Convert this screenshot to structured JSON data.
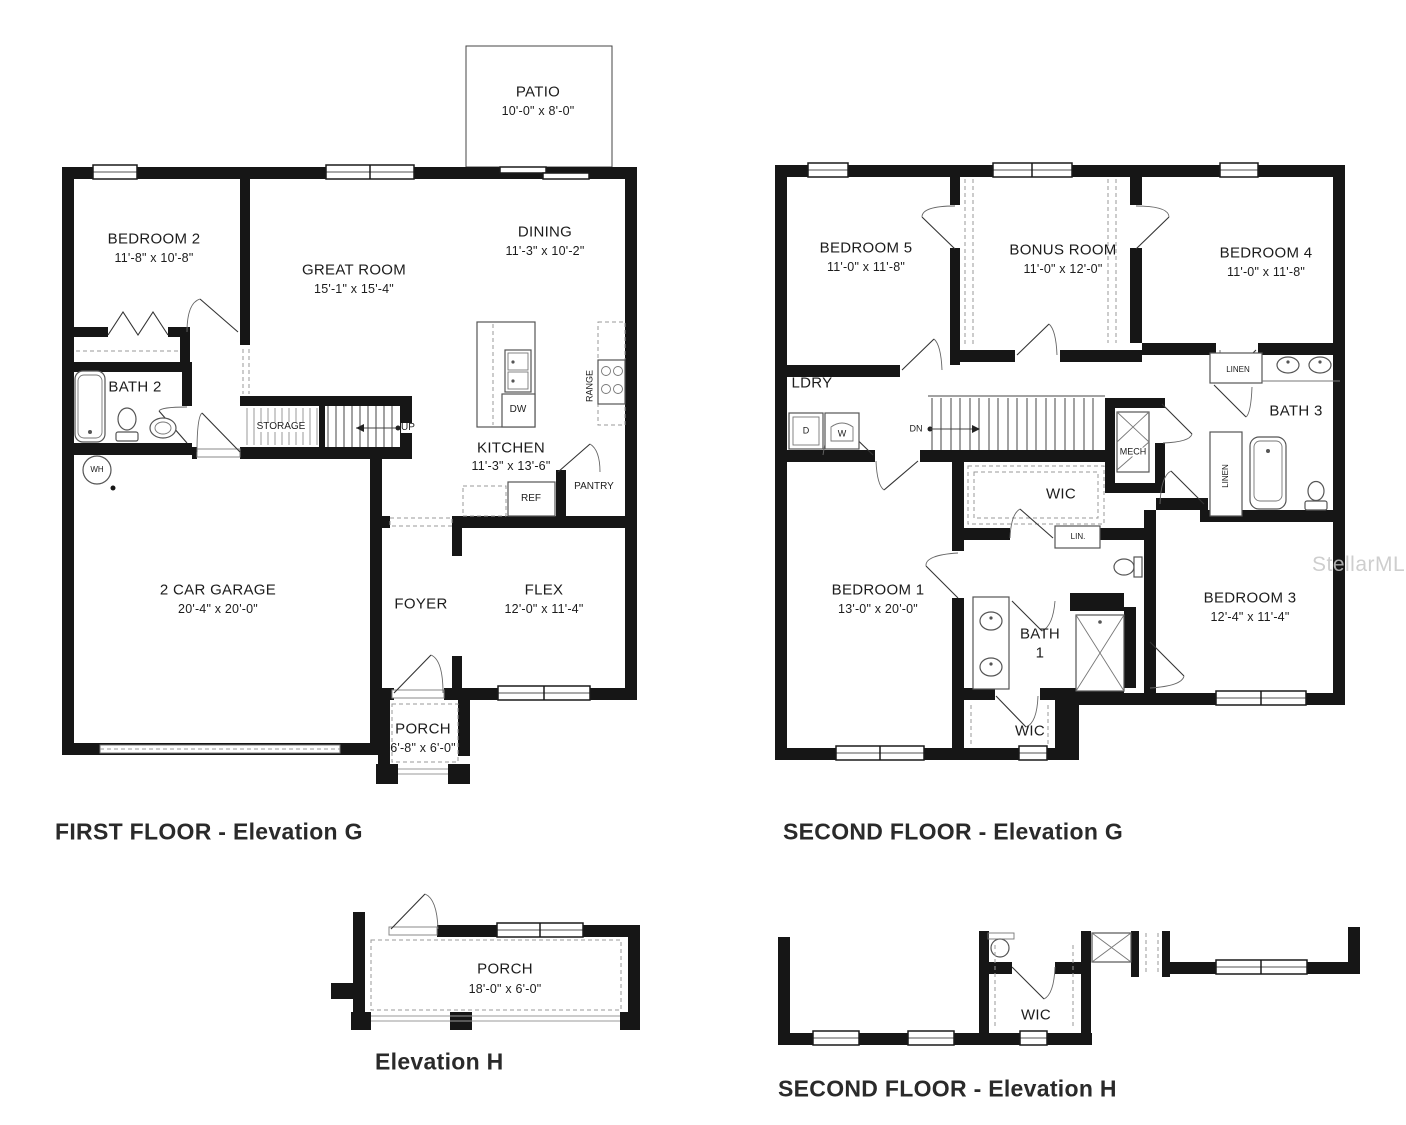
{
  "watermark": "StellarMLS",
  "first_floor": {
    "caption": "FIRST FLOOR - Elevation G",
    "rooms": {
      "patio": {
        "name": "PATIO",
        "dims": "10'-0\" x 8'-0\""
      },
      "bedroom2": {
        "name": "BEDROOM 2",
        "dims": "11'-8\" x 10'-8\""
      },
      "great_room": {
        "name": "GREAT ROOM",
        "dims": "15'-1\" x 15'-4\""
      },
      "dining": {
        "name": "DINING",
        "dims": "11'-3\" x 10'-2\""
      },
      "bath2": {
        "name": "BATH 2"
      },
      "kitchen": {
        "name": "KITCHEN",
        "dims": "11'-3\" x 13'-6\""
      },
      "garage": {
        "name": "2 CAR GARAGE",
        "dims": "20'-4\" x 20'-0\""
      },
      "foyer": {
        "name": "FOYER"
      },
      "flex": {
        "name": "FLEX",
        "dims": "12'-0\" x 11'-4\""
      },
      "porch": {
        "name": "PORCH",
        "dims": "6'-8\" x 6'-0\""
      }
    },
    "labels": {
      "storage": "STORAGE",
      "up": "UP",
      "wh": "WH",
      "dw": "DW",
      "range": "RANGE",
      "ref": "REF",
      "pantry": "PANTRY"
    }
  },
  "second_floor": {
    "caption": "SECOND FLOOR - Elevation G",
    "rooms": {
      "bedroom5": {
        "name": "BEDROOM 5",
        "dims": "11'-0\" x 11'-8\""
      },
      "bonus_room": {
        "name": "BONUS ROOM",
        "dims": "11'-0\" x 12'-0\""
      },
      "bedroom4": {
        "name": "BEDROOM 4",
        "dims": "11'-0\" x 11'-8\""
      },
      "bedroom1": {
        "name": "BEDROOM 1",
        "dims": "13'-0\" x 20'-0\""
      },
      "bedroom3": {
        "name": "BEDROOM 3",
        "dims": "12'-4\" x 11'-4\""
      },
      "ldry": {
        "name": "LDRY"
      },
      "bath3": {
        "name": "BATH 3"
      },
      "bath1": {
        "name": "BATH",
        "name2": "1"
      },
      "wic_upper": {
        "name": "WIC"
      },
      "wic_lower": {
        "name": "WIC"
      }
    },
    "labels": {
      "dn": "DN",
      "mech": "MECH",
      "linen_top": "LINEN",
      "linen_side": "LINEN",
      "lin": "LIN.",
      "d": "D",
      "w": "W"
    }
  },
  "elevation_h": {
    "caption": "Elevation H",
    "rooms": {
      "porch": {
        "name": "PORCH",
        "dims": "18'-0\" x 6'-0\""
      }
    }
  },
  "second_floor_h": {
    "caption": "SECOND FLOOR - Elevation H",
    "rooms": {
      "wic": {
        "name": "WIC"
      }
    }
  }
}
